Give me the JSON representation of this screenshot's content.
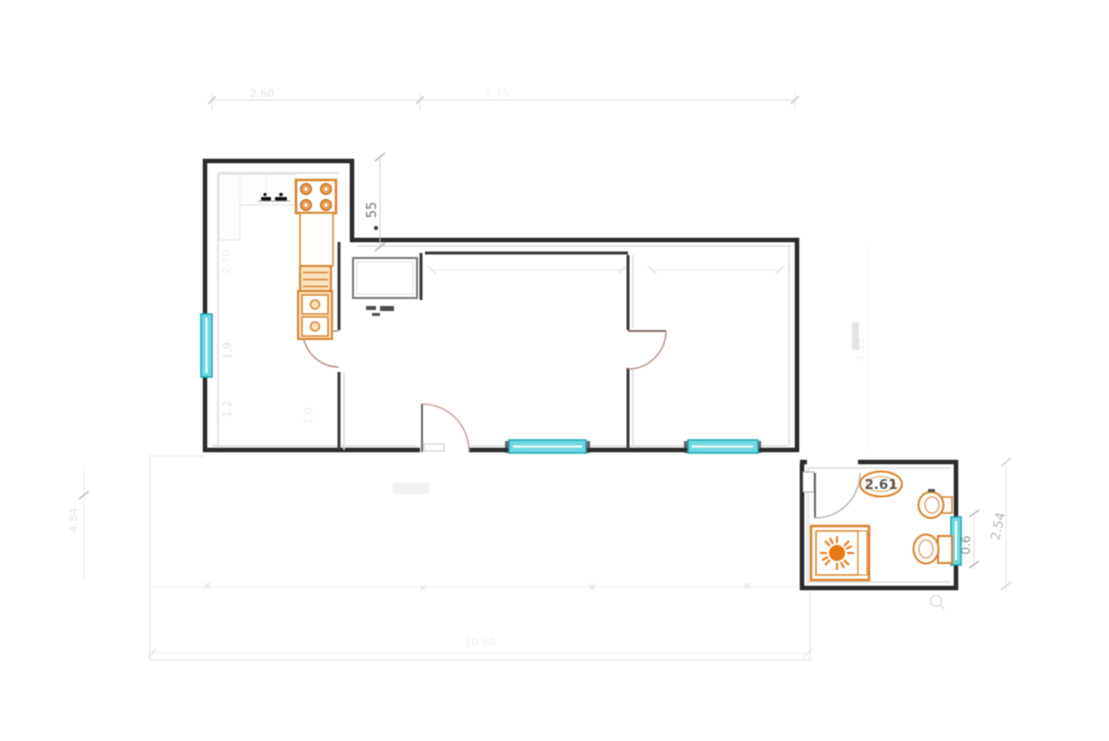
{
  "plan": {
    "dims": {
      "top_left": "2.60",
      "top_right": "5.75",
      "step": "55",
      "kitchen_depth": "2.70",
      "kitchen_a": "1.9",
      "kitchen_b": "1.2",
      "kitchen_c": "1.0",
      "left_height": "4.84",
      "right_main": "3.55",
      "bath_width": "2.61",
      "bath_window_width": "0.6",
      "bath_depth": "2.54",
      "bottom_width": "10.60"
    }
  },
  "colors": {
    "wall": "#2a2a2a",
    "interior_wall": "#3a3a3a",
    "faint_line": "#e6e6e6",
    "window_fill": "#6fd9e2",
    "window_border": "#1fa6b2",
    "fixture_orange": "#d9832e",
    "fixture_fill": "#fbe3c0",
    "shower_sun": "#e87816",
    "door_arc": "#bb9287"
  },
  "fixtures": {
    "kitchen": [
      "stove-4-burner",
      "counter",
      "drawer-unit",
      "double-sink",
      "wall-counter-with-faucet"
    ],
    "bathroom": [
      "shower-tray",
      "washbasin",
      "bidet",
      "toilet",
      "floor-drain"
    ],
    "windows": [
      "kitchen-window",
      "living-room-window",
      "bedroom-window",
      "bathroom-window"
    ],
    "doors": [
      "kitchen-door",
      "bedroom-door",
      "entry-door",
      "bathroom-door"
    ]
  }
}
